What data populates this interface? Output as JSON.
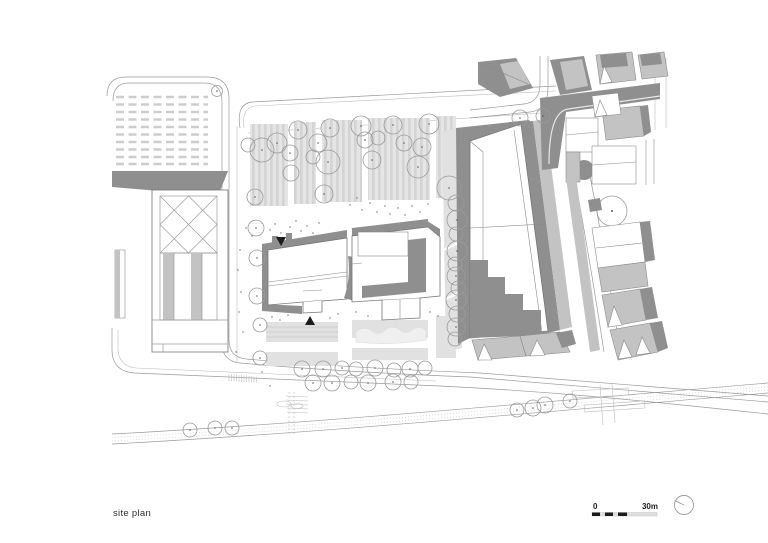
{
  "page": {
    "kind": "architectural site plan",
    "background": "#ffffff"
  },
  "caption": {
    "label": "site plan"
  },
  "scale_bar": {
    "zero_label": "0",
    "end_label": "30m"
  },
  "north_indicator": {
    "icon": "north-dial-icon"
  },
  "palette": {
    "roof_shadow": "#8f8f8f",
    "roof_mid": "#c3c3c3",
    "ground_light": "#e1e1e1",
    "stripe_a": "#e5e5e5",
    "stripe_b": "#d4d4d4",
    "line": "#9a9a9a",
    "line_dark": "#5c5c5c",
    "accent_black": "#1c1c1c",
    "paper": "#ffffff"
  }
}
